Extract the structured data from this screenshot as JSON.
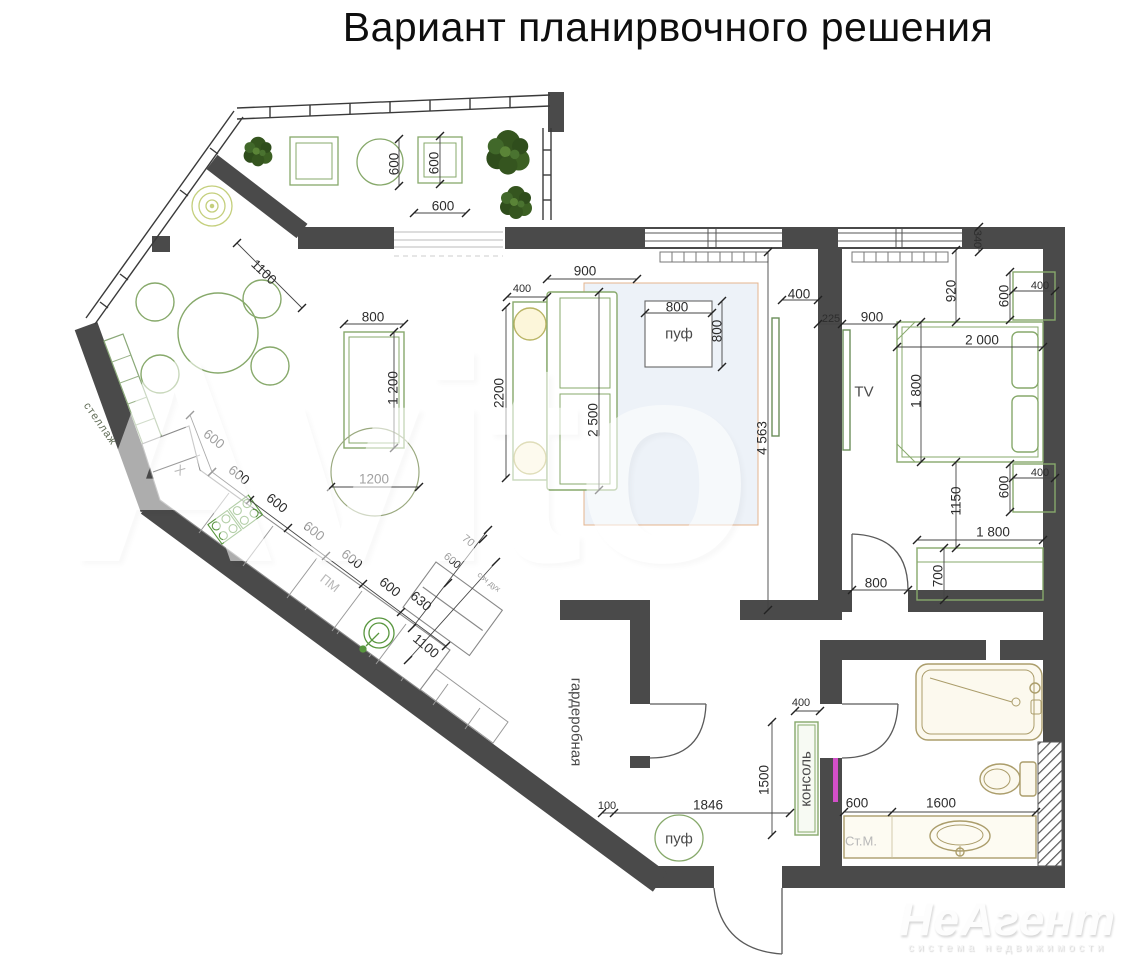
{
  "title": "Вариант планирвочного решения",
  "watermarks": {
    "center": "Avito",
    "logo": "НеАгент",
    "tagline": "система недвижимости"
  },
  "colors": {
    "wall": "#4a4a4a",
    "furniture_green": "#87a96b",
    "kitchen_green": "#58963e",
    "bath_tan": "#ab9d6b",
    "rug_fill": "#edf2f8",
    "rug_border": "#e5b48e",
    "lamp": "#c4cf7c",
    "mirror": "#d24fc8",
    "plant": "#35551f",
    "dim_text": "#2d2d2d"
  },
  "plan": {
    "labels": [
      {
        "t": "стеллаж",
        "x": 100,
        "y": 424,
        "r": 55,
        "c": "room-xs",
        "n": "room-label-shelving"
      },
      {
        "t": "X",
        "x": 180,
        "y": 470,
        "r": 38,
        "c": "faded",
        "n": "kitchen-unit-label"
      },
      {
        "t": "ПМ",
        "x": 330,
        "y": 583,
        "r": 38,
        "c": "faded",
        "n": "dishwasher-label"
      },
      {
        "t": "свч дух",
        "x": 489,
        "y": 582,
        "r": 38,
        "c": "tiny",
        "n": "oven-unit-label"
      },
      {
        "t": "гардеробная",
        "x": 576,
        "y": 722,
        "r": 90,
        "c": "room",
        "n": "room-label-wardrobe"
      },
      {
        "t": "пуф",
        "x": 679,
        "y": 334,
        "r": 0,
        "c": "room",
        "n": "pouf-label"
      },
      {
        "t": "пуф",
        "x": 679,
        "y": 839,
        "r": 0,
        "c": "room",
        "n": "pouf-label"
      },
      {
        "t": "TV",
        "x": 864,
        "y": 392,
        "r": 0,
        "c": "room",
        "n": "tv-label"
      },
      {
        "t": "консоль",
        "x": 806,
        "y": 779,
        "r": -90,
        "c": "room",
        "n": "console-label"
      },
      {
        "t": "Ст.М.",
        "x": 861,
        "y": 841,
        "r": 0,
        "c": "faded",
        "n": "washing-machine-label"
      },
      {
        "t": "600",
        "x": 394,
        "y": 164,
        "r": -90,
        "c": "dim"
      },
      {
        "t": "600",
        "x": 434,
        "y": 163,
        "r": -90,
        "c": "dim"
      },
      {
        "t": "600",
        "x": 443,
        "y": 206,
        "r": 0,
        "c": "dim"
      },
      {
        "t": "1100",
        "x": 264,
        "y": 272,
        "r": 44,
        "c": "dim"
      },
      {
        "t": "800",
        "x": 373,
        "y": 317,
        "r": 0,
        "c": "dim"
      },
      {
        "t": "1 200",
        "x": 393,
        "y": 388,
        "r": -90,
        "c": "dim"
      },
      {
        "t": "1200",
        "x": 374,
        "y": 479,
        "r": 0,
        "c": "dim"
      },
      {
        "t": "400",
        "x": 522,
        "y": 289,
        "r": 0,
        "c": "dim-sm"
      },
      {
        "t": "900",
        "x": 585,
        "y": 271,
        "r": 0,
        "c": "dim"
      },
      {
        "t": "2200",
        "x": 499,
        "y": 393,
        "r": -90,
        "c": "dim"
      },
      {
        "t": "2 500",
        "x": 593,
        "y": 420,
        "r": -90,
        "c": "dim"
      },
      {
        "t": "800",
        "x": 677,
        "y": 307,
        "r": 0,
        "c": "dim"
      },
      {
        "t": "800",
        "x": 717,
        "y": 331,
        "r": -90,
        "c": "dim"
      },
      {
        "t": "400",
        "x": 799,
        "y": 294,
        "r": 0,
        "c": "dim"
      },
      {
        "t": "4 563",
        "x": 762,
        "y": 438,
        "r": -90,
        "c": "dim"
      },
      {
        "t": "340",
        "x": 977,
        "y": 239,
        "r": 90,
        "c": "dim-sm"
      },
      {
        "t": "920",
        "x": 951,
        "y": 291,
        "r": -90,
        "c": "dim"
      },
      {
        "t": "600",
        "x": 1004,
        "y": 296,
        "r": -90,
        "c": "dim"
      },
      {
        "t": "400",
        "x": 1040,
        "y": 286,
        "r": 0,
        "c": "dim-sm"
      },
      {
        "t": "225",
        "x": 831,
        "y": 319,
        "r": 0,
        "c": "dim-sm"
      },
      {
        "t": "900",
        "x": 872,
        "y": 317,
        "r": 0,
        "c": "dim"
      },
      {
        "t": "2 000",
        "x": 982,
        "y": 340,
        "r": 0,
        "c": "dim"
      },
      {
        "t": "1 800",
        "x": 916,
        "y": 391,
        "r": -90,
        "c": "dim"
      },
      {
        "t": "600",
        "x": 1004,
        "y": 487,
        "r": -90,
        "c": "dim"
      },
      {
        "t": "400",
        "x": 1040,
        "y": 473,
        "r": 0,
        "c": "dim-sm"
      },
      {
        "t": "1150",
        "x": 956,
        "y": 501,
        "r": -90,
        "c": "dim"
      },
      {
        "t": "1 800",
        "x": 993,
        "y": 532,
        "r": 0,
        "c": "dim"
      },
      {
        "t": "700",
        "x": 938,
        "y": 576,
        "r": -90,
        "c": "dim"
      },
      {
        "t": "800",
        "x": 876,
        "y": 583,
        "r": 0,
        "c": "dim"
      },
      {
        "t": "400",
        "x": 801,
        "y": 703,
        "r": 0,
        "c": "dim-sm"
      },
      {
        "t": "1500",
        "x": 764,
        "y": 780,
        "r": -90,
        "c": "dim"
      },
      {
        "t": "100",
        "x": 607,
        "y": 806,
        "r": 0,
        "c": "dim-sm"
      },
      {
        "t": "1846",
        "x": 708,
        "y": 805,
        "r": 0,
        "c": "dim"
      },
      {
        "t": "600",
        "x": 857,
        "y": 803,
        "r": 0,
        "c": "dim"
      },
      {
        "t": "1600",
        "x": 941,
        "y": 803,
        "r": 0,
        "c": "dim"
      },
      {
        "t": "600",
        "x": 214,
        "y": 439,
        "r": 38,
        "c": "dim"
      },
      {
        "t": "600",
        "x": 239,
        "y": 475,
        "r": 38,
        "c": "dim"
      },
      {
        "t": "600",
        "x": 277,
        "y": 503,
        "r": 38,
        "c": "dim"
      },
      {
        "t": "600",
        "x": 314,
        "y": 531,
        "r": 38,
        "c": "dim"
      },
      {
        "t": "600",
        "x": 352,
        "y": 559,
        "r": 38,
        "c": "dim"
      },
      {
        "t": "600",
        "x": 390,
        "y": 587,
        "r": 38,
        "c": "dim"
      },
      {
        "t": "630",
        "x": 421,
        "y": 601,
        "r": 40,
        "c": "dim"
      },
      {
        "t": "600",
        "x": 452,
        "y": 561,
        "r": 40,
        "c": "dim-sm"
      },
      {
        "t": "70",
        "x": 468,
        "y": 541,
        "r": 40,
        "c": "dim-sm"
      },
      {
        "t": "1100",
        "x": 426,
        "y": 646,
        "r": 40,
        "c": "dim"
      }
    ]
  }
}
